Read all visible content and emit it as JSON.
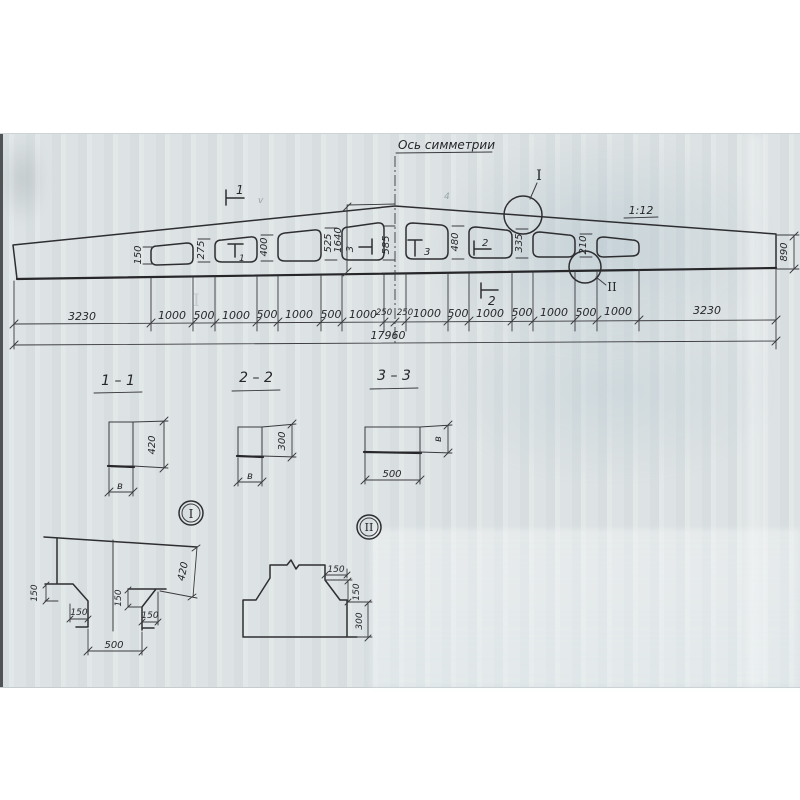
{
  "colors": {
    "paper": "#dfe4e5",
    "ink": "#2e2e31"
  },
  "drawing": {
    "axis_label": "Ось симметрии",
    "slope_label": "1:12",
    "total": "17960",
    "end_height": "890",
    "ridge": "1640",
    "web_dims": [
      "150",
      "275",
      "400",
      "525",
      "585",
      "480",
      "335",
      "210"
    ],
    "dim_row": [
      "3230",
      "1000",
      "500",
      "1000",
      "500",
      "1000",
      "500",
      "1000",
      "250",
      "250",
      "1000",
      "500",
      "1000",
      "500",
      "1000",
      "500",
      "1000",
      "3230"
    ],
    "cut_marks": {
      "top1": "1",
      "bottom2": "2",
      "hole2": "1",
      "hole4": "3",
      "hole5": "3",
      "hole6": "2"
    }
  },
  "sections": [
    {
      "title": "1 – 1",
      "a": "420",
      "b": "в"
    },
    {
      "title": "2 – 2",
      "a": "300",
      "b": "в"
    },
    {
      "title": "3 – 3",
      "a": "500",
      "b": "в"
    }
  ],
  "details": {
    "i": {
      "ref": "I",
      "v1": "150",
      "h1": "150",
      "v2": "150",
      "h2": "150",
      "depth": "420",
      "width": "500"
    },
    "ii": {
      "ref": "II",
      "h": "150",
      "v": "150",
      "height": "300"
    }
  },
  "artifacts": {
    "m1": "v",
    "m2": "4",
    "bleed": "I"
  }
}
